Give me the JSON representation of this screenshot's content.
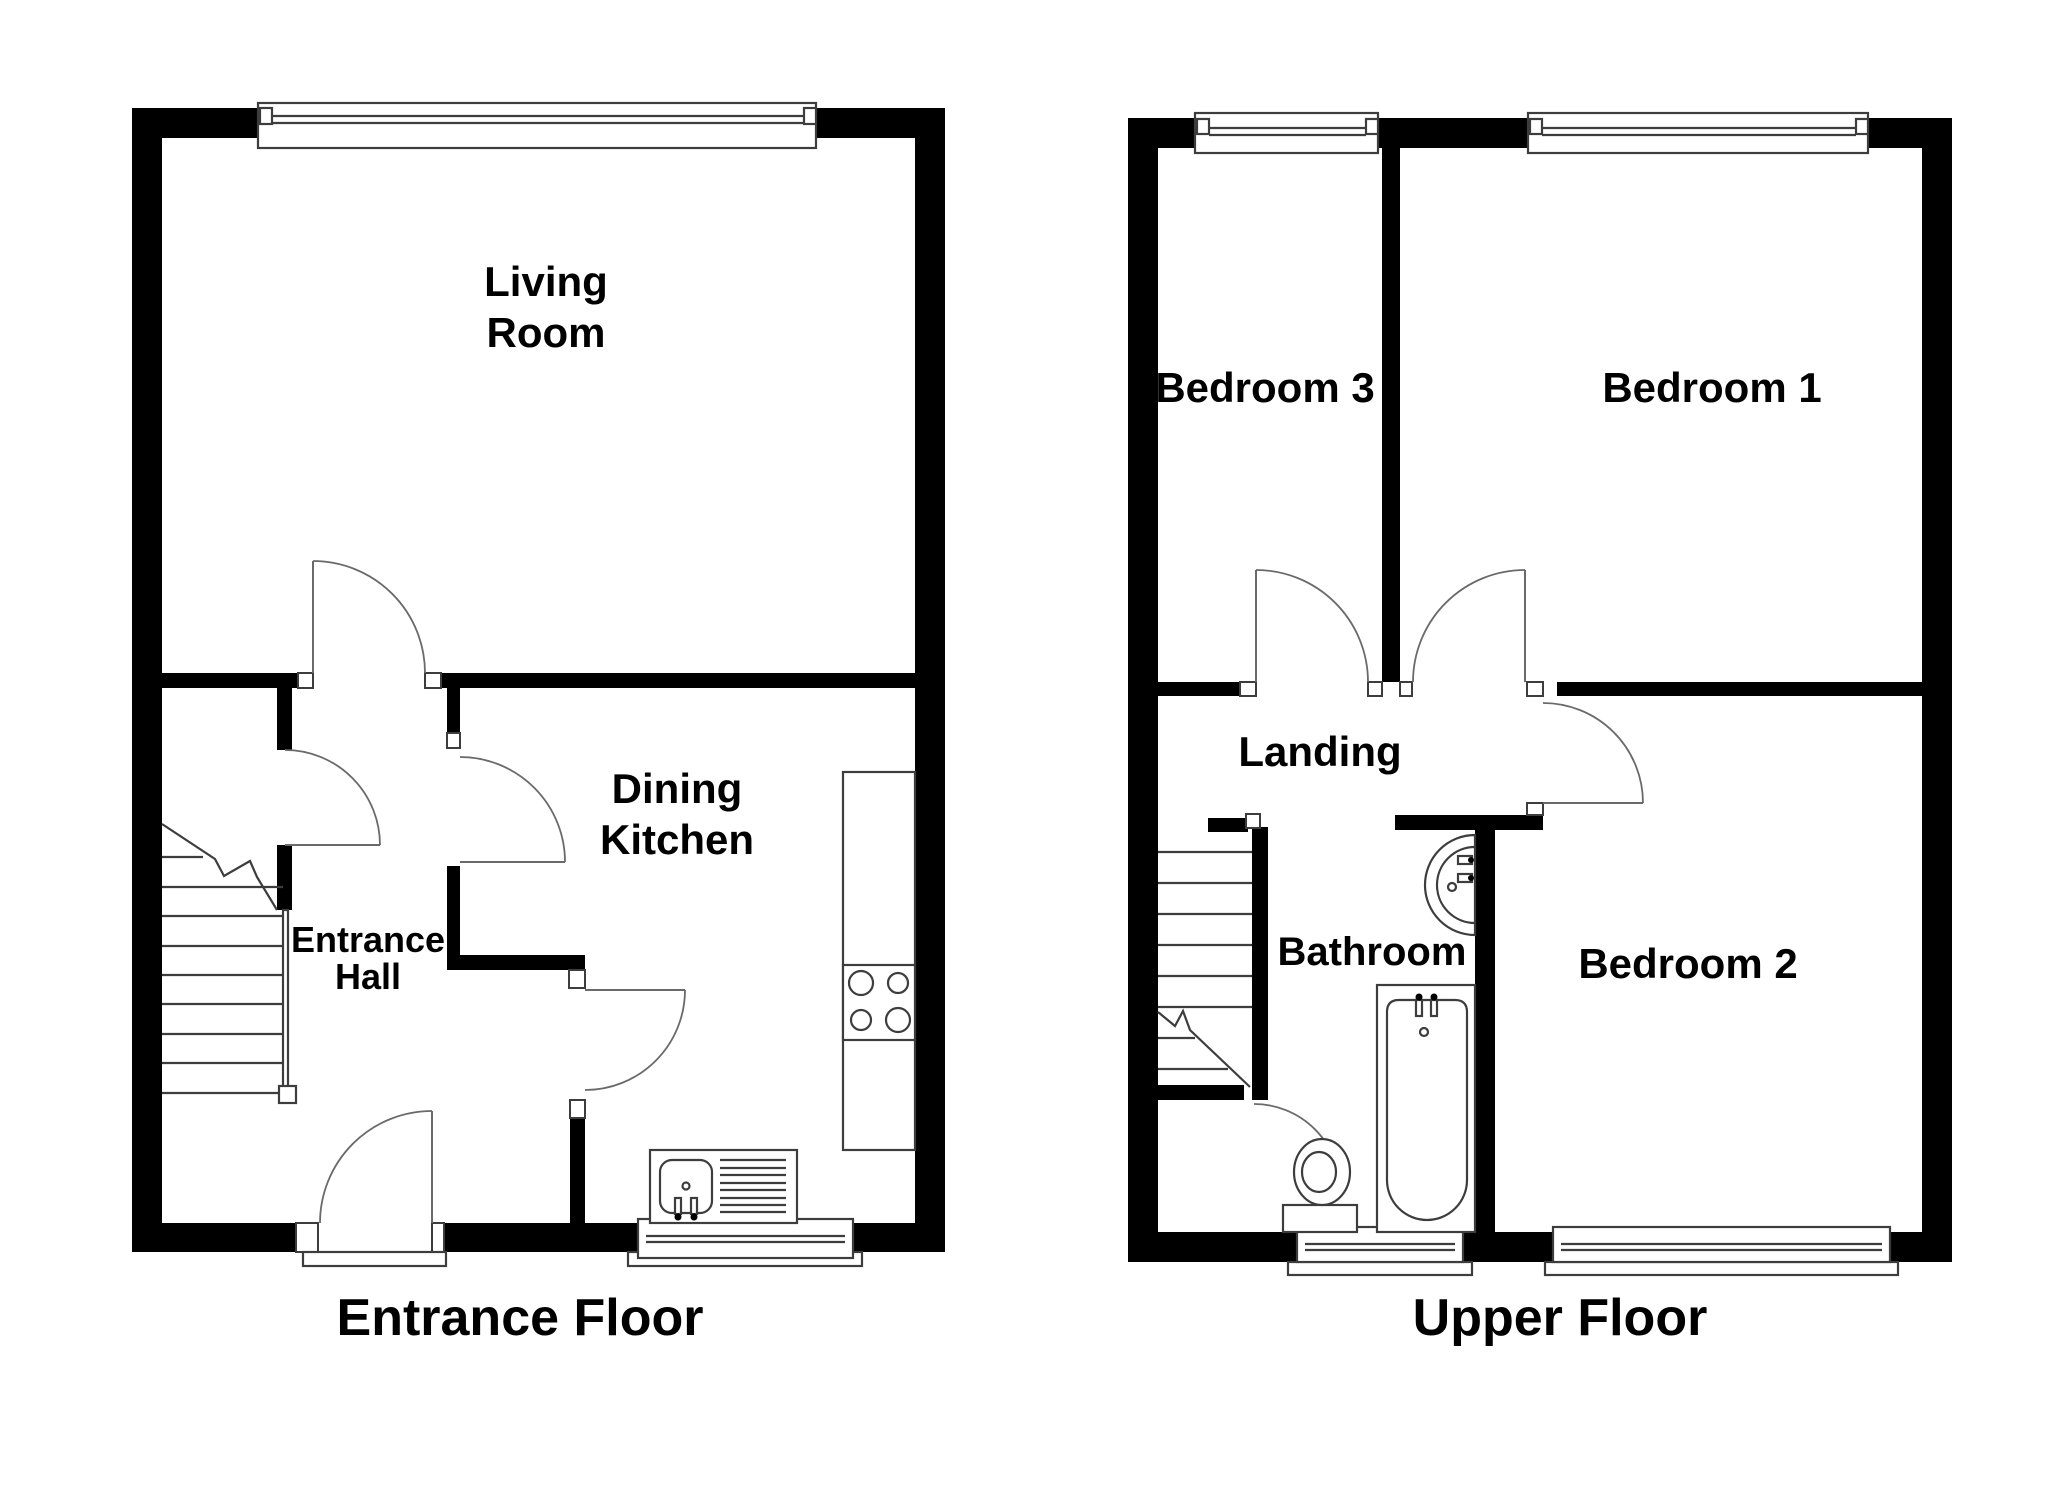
{
  "floorplan": {
    "entrance": {
      "title": "Entrance Floor",
      "rooms": {
        "living_room": {
          "line1": "Living",
          "line2": "Room"
        },
        "dining_kitchen": {
          "line1": "Dining",
          "line2": "Kitchen"
        },
        "entrance_hall": {
          "line1": "Entrance",
          "line2": "Hall"
        }
      },
      "fixtures": [
        "staircase",
        "front-door",
        "living-room-door",
        "stairs-door",
        "kitchen-door",
        "hall-kitchen-door",
        "kitchen-counter",
        "hob",
        "sink-with-drainer",
        "living-room-window",
        "kitchen-window",
        "porch-step"
      ]
    },
    "upper": {
      "title": "Upper Floor",
      "rooms": {
        "bedroom3": {
          "label": "Bedroom 3"
        },
        "bedroom1": {
          "label": "Bedroom 1"
        },
        "bedroom2": {
          "label": "Bedroom 2"
        },
        "landing": {
          "label": "Landing"
        },
        "bathroom": {
          "label": "Bathroom"
        }
      },
      "fixtures": [
        "staircase",
        "bedroom3-door",
        "bedroom1-door",
        "bedroom2-door",
        "bathroom-door",
        "bath",
        "toilet",
        "basin",
        "bedroom3-window",
        "bedroom1-window",
        "bathroom-window",
        "bedroom2-window"
      ]
    },
    "colors": {
      "wall": "#000000",
      "thin_line": "#3d3d3d",
      "door_arc": "#6a6a6a",
      "background": "#ffffff",
      "text": "#000000"
    }
  }
}
